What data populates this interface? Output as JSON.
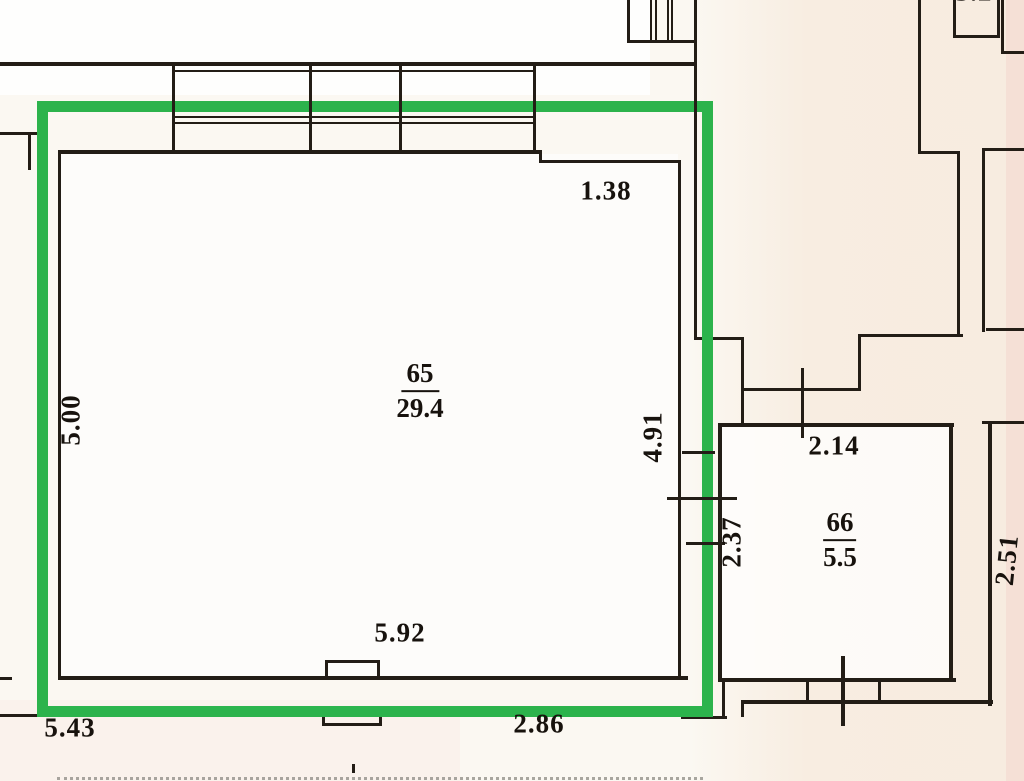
{
  "document": {
    "kind": "scanned floor plan with highlight annotation"
  },
  "annotation": {
    "highlight_color": "#2cb34c"
  },
  "rooms": {
    "r65": {
      "number": "65",
      "area": "29.4"
    },
    "r66": {
      "number": "66",
      "area": "5.5"
    }
  },
  "dimensions": {
    "d500": "5.00",
    "d138": "1.38",
    "d491": "4.91",
    "d237": "2.37",
    "d214": "2.14",
    "d592": "5.92",
    "d543": "5.43",
    "d286": "2.86",
    "d251": "2.51",
    "d32": "3.2"
  }
}
